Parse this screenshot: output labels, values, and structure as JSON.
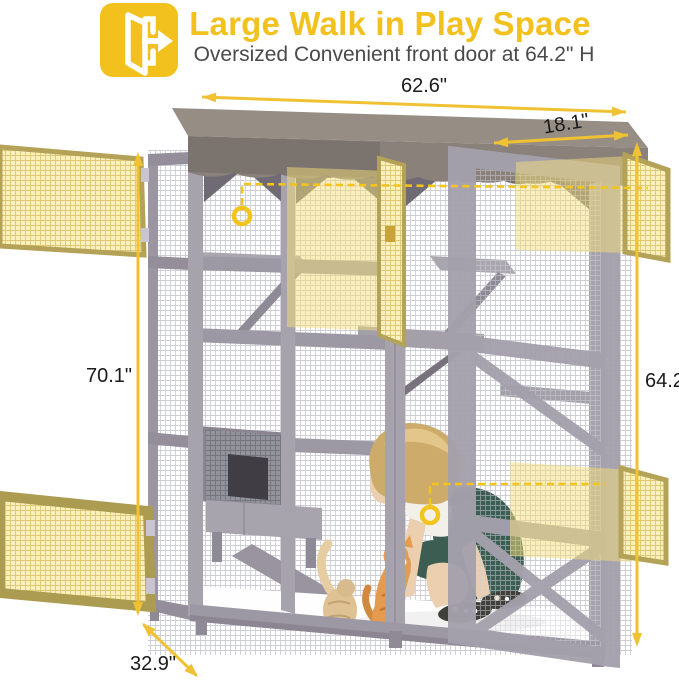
{
  "header": {
    "icon": "open-door-exit-icon",
    "title": "Large Walk in Play Space",
    "subtitle": "Oversized Convenient front door at 64.2\" H"
  },
  "dimensions": {
    "top_width": "62.6\"",
    "top_depth": "18.1\"",
    "left_height": "70.1\"",
    "right_door_height": "64.2\"",
    "bottom_depth": "32.9\""
  },
  "colors": {
    "accent_yellow": "#F2C11D",
    "annotation_yellow": "#F0C233",
    "dashed_yellow": "#F2C41C",
    "door_highlight": "#F3DD79",
    "frame_gray": "#9D99A4",
    "canopy_taupe": "#89817A",
    "subtitle_gray": "#4A4A4A",
    "label_black": "#1B1B1B"
  }
}
